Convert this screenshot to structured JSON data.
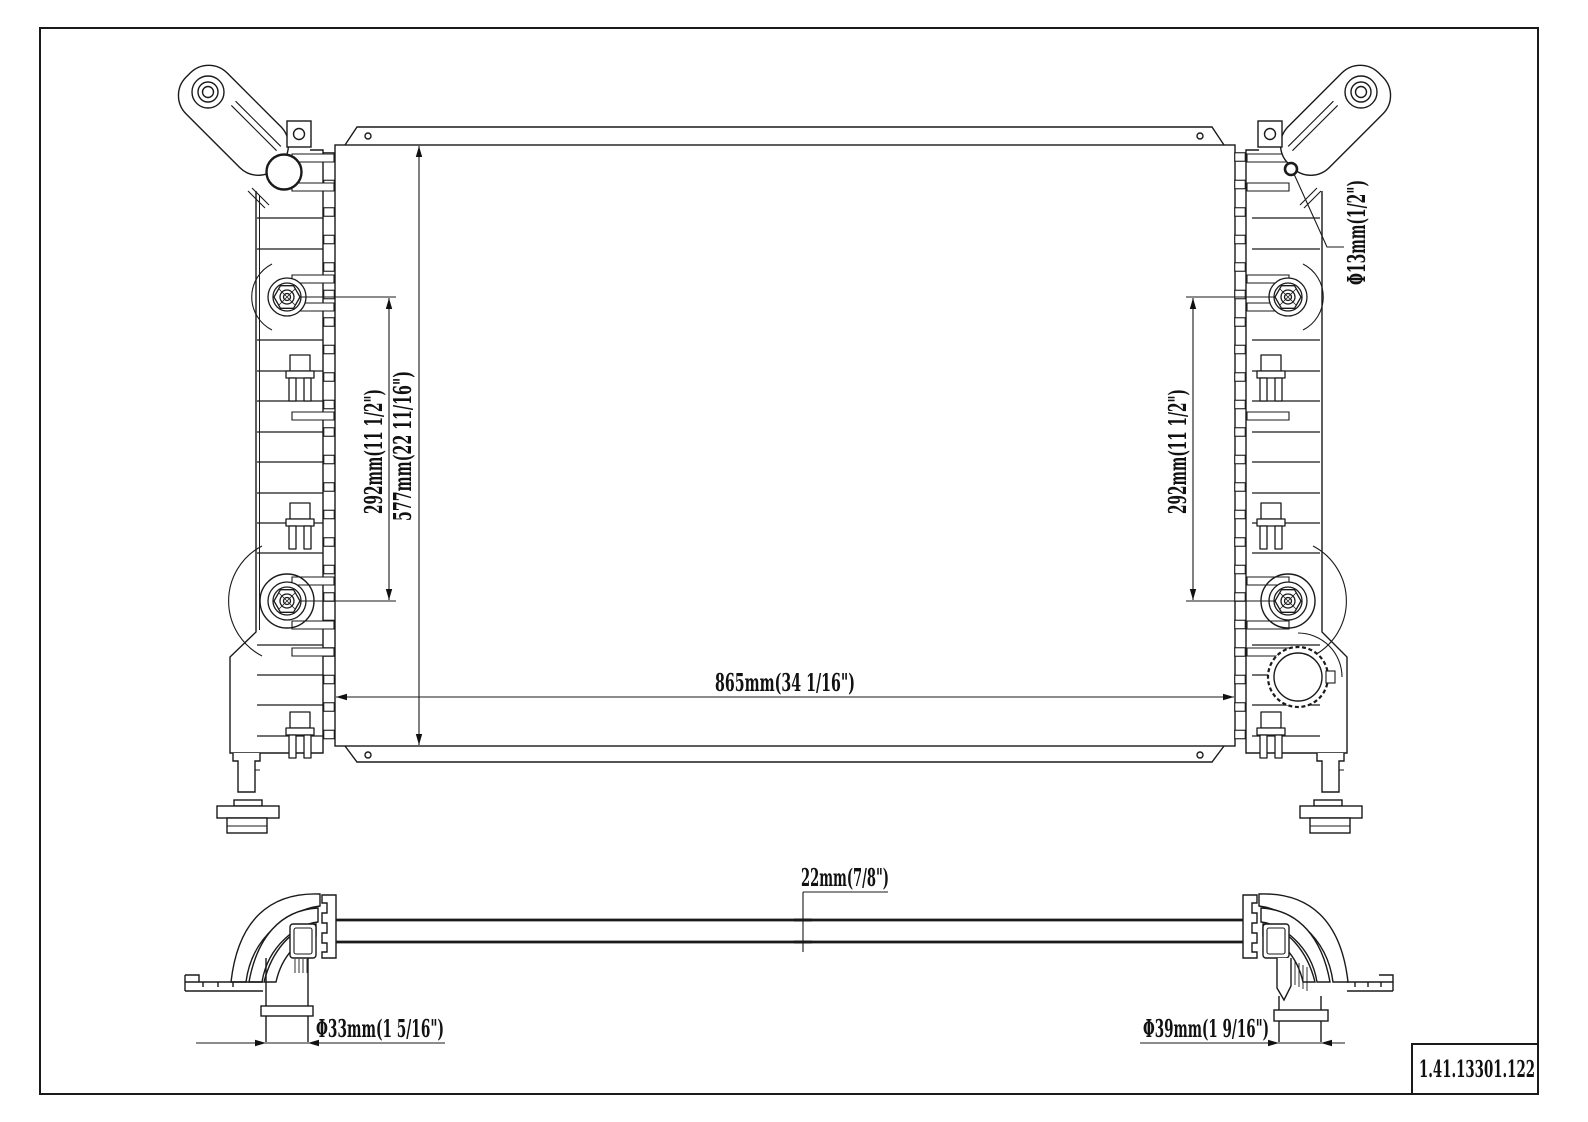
{
  "drawing": {
    "title_block": {
      "part_number": "1.41.13301.122"
    },
    "front_view": {
      "dim_left_fitting_spacing": "292mm(11 1/2\")",
      "dim_core_height": "577mm(22 11/16\")",
      "dim_core_width": "865mm(34 1/16\")",
      "dim_right_fitting_spacing": "292mm(11 1/2\")",
      "dim_bracket_hole_diameter": "Φ13mm(1/2\")"
    },
    "bottom_view": {
      "dim_core_thickness": "22mm(7/8\")",
      "dim_left_pipe_diameter": "Φ33mm(1 5/16\")",
      "dim_right_pipe_diameter": "Φ39mm(1 9/16\")"
    }
  }
}
